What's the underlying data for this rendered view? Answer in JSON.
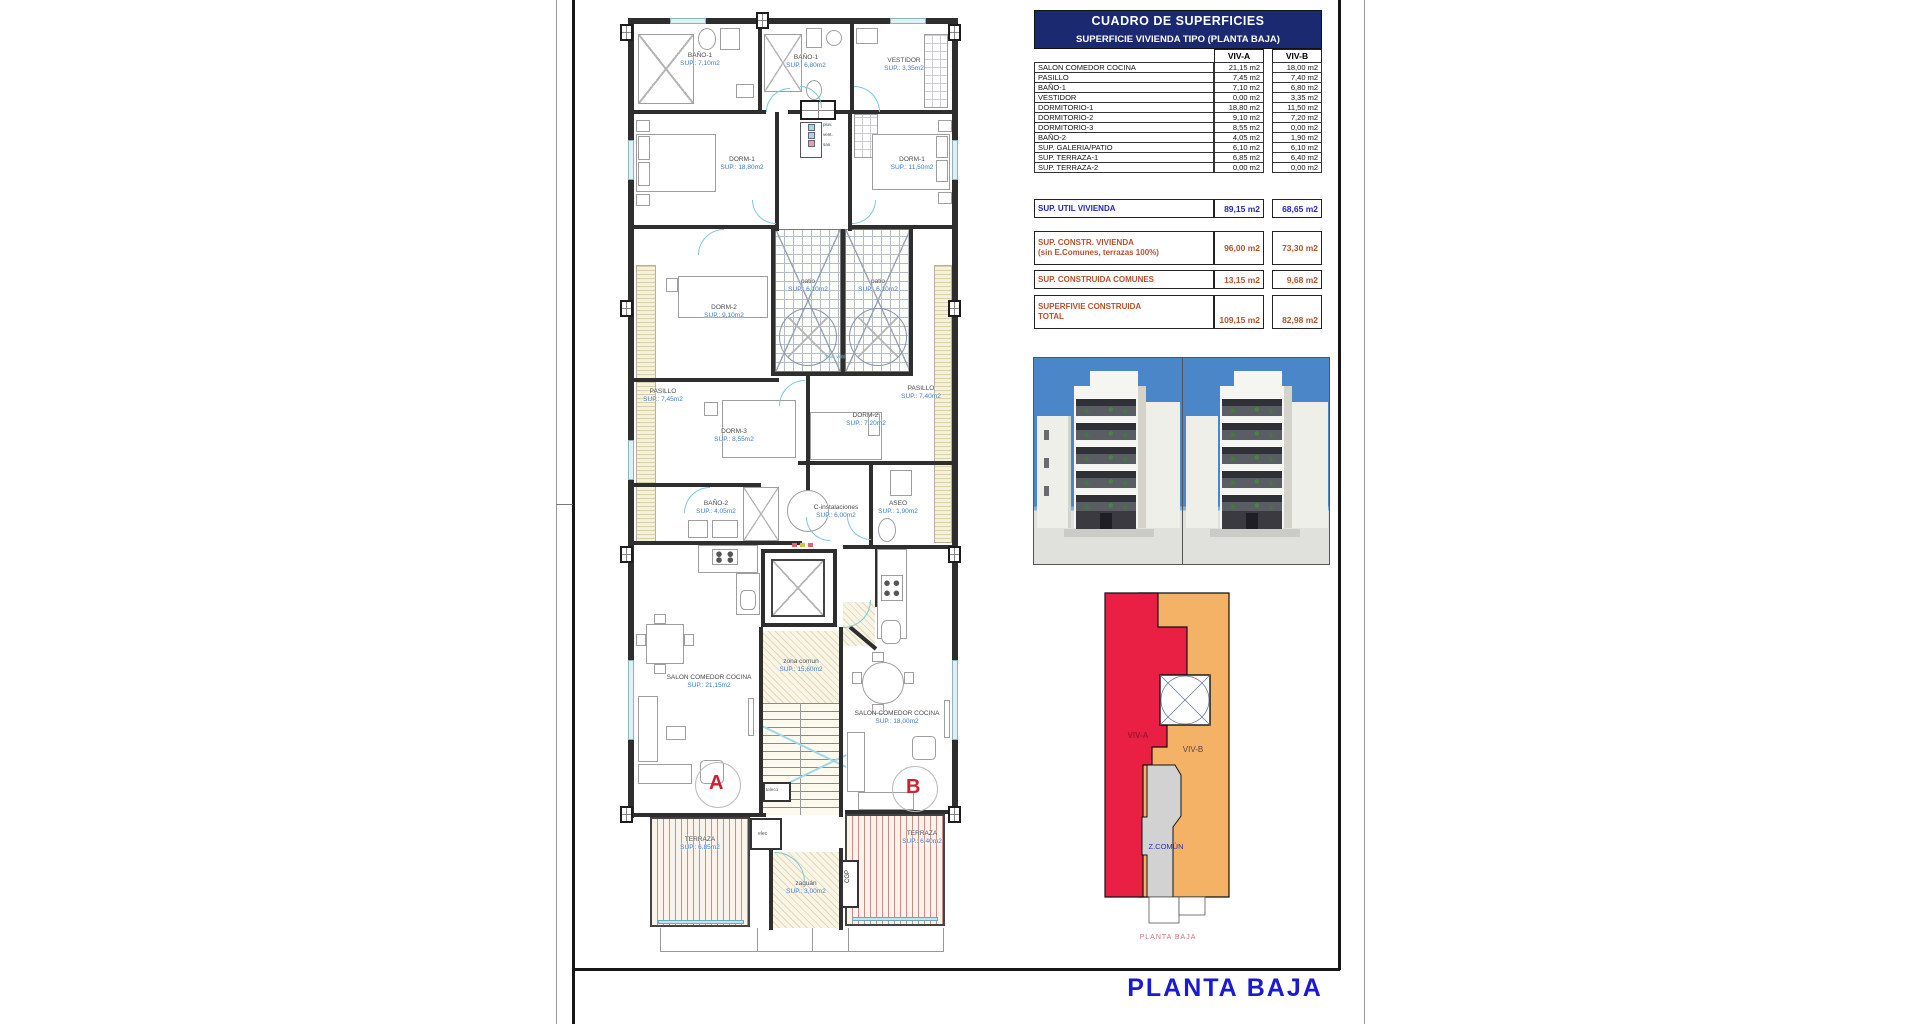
{
  "sheet": {
    "title": "PLANTA BAJA",
    "key_caption": "PLANTA BAJA"
  },
  "table": {
    "title": "CUADRO DE SUPERFICIES",
    "subtitle": "SUPERFICIE VIVIENDA TIPO  (PLANTA BAJA)",
    "col_a": "VIV-A",
    "col_b": "VIV-B",
    "rows": [
      {
        "label": "SALON COMEDOR COCINA",
        "a": "21,15 m2",
        "b": "18,00 m2"
      },
      {
        "label": "PASILLO",
        "a": "7,45 m2",
        "b": "7,40 m2"
      },
      {
        "label": "BAÑO-1",
        "a": "7,10 m2",
        "b": "6,80 m2"
      },
      {
        "label": "VESTIDOR",
        "a": "0,00 m2",
        "b": "3,35 m2"
      },
      {
        "label": "DORMITORIO-1",
        "a": "18,80 m2",
        "b": "11,50 m2"
      },
      {
        "label": "DORMITORIO-2",
        "a": "9,10 m2",
        "b": "7,20 m2"
      },
      {
        "label": "DORMITORIO-3",
        "a": "8,55 m2",
        "b": "0,00 m2"
      },
      {
        "label": "BAÑO-2",
        "a": "4,05 m2",
        "b": "1,90 m2"
      },
      {
        "label": "SUP. GALERIA/PATIO",
        "a": "6,10 m2",
        "b": "6,10 m2"
      },
      {
        "label": "SUP. TERRAZA-1",
        "a": "6,85 m2",
        "b": "6,40 m2"
      },
      {
        "label": "SUP. TERRAZA-2",
        "a": "0,00 m2",
        "b": "0,00 m2"
      }
    ],
    "summary": [
      {
        "label": "SUP. UTIL VIVIENDA",
        "label2": "",
        "a": "89,15 m2",
        "b": "68,65 m2"
      },
      {
        "label": "SUP. CONSTR. VIVIENDA",
        "label2": "(sin E.Comunes, terrazas 100%)",
        "a": "96,00 m2",
        "b": "73,30 m2"
      },
      {
        "label": "SUP. CONSTRUIDA COMUNES",
        "label2": "",
        "a": "13,15 m2",
        "b": "9,68 m2"
      },
      {
        "label": "SUPERFIVIE CONSTRUIDA",
        "label2": "TOTAL",
        "a": "109,15 m2",
        "b": "82,98 m2"
      }
    ]
  },
  "plan": {
    "unit_a": "A",
    "unit_b": "B",
    "rooms": [
      {
        "label": "BAÑO-1",
        "sup": "SUP.: 7,10m2"
      },
      {
        "label": "BAÑO-1",
        "sup": "SUP.: 6,80m2"
      },
      {
        "label": "VESTIDOR",
        "sup": "SUP.: 3,35m2"
      },
      {
        "label": "DORM-1",
        "sup": "SUP.: 18,80m2"
      },
      {
        "label": "DORM-1",
        "sup": "SUP.: 11,50m2"
      },
      {
        "label": "patio",
        "sup": "SUP.: 6,10m2"
      },
      {
        "label": "patio",
        "sup": "SUP.: 6,10m2"
      },
      {
        "label": "DORM-2",
        "sup": "SUP.: 9,10m2"
      },
      {
        "label": "PASILLO",
        "sup": "SUP.: 7,45m2"
      },
      {
        "label": "PASILLO",
        "sup": "SUP.: 7,40m2"
      },
      {
        "label": "DORM-3",
        "sup": "SUP.: 8,55m2"
      },
      {
        "label": "DORM-2'",
        "sup": "SUP.: 7,20m2"
      },
      {
        "label": "BAÑO-2",
        "sup": "SUP.: 4,05m2"
      },
      {
        "label": "C-instalaciones",
        "sup": "SUP.: 6,00m2"
      },
      {
        "label": "ASEO",
        "sup": "SUP.: 1,90m2"
      },
      {
        "label": "zona comun",
        "sup": "SUP.: 15,60m2"
      },
      {
        "label": "SALON COMEDOR COCINA",
        "sup": "SUP.: 21,15m2"
      },
      {
        "label": "SALON COMEDOR COCINA",
        "sup": "SUP.: 18,00m2"
      },
      {
        "label": "TERRAZA",
        "sup": "SUP.: 6,85m2"
      },
      {
        "label": "TERRAZA",
        "sup": "SUP.: 6,40m2"
      },
      {
        "label": "zaguán",
        "sup": "SUP.: 3,00m2"
      }
    ],
    "annotations": {
      "elec": "elec",
      "teleco": "teleco",
      "cgp": "CGP",
      "legend1": "pluv.",
      "legend2": "vent.",
      "legend3": "san.",
      "drains": "pluv. vent."
    }
  },
  "key_diagram": {
    "viv_a": "VIV-A",
    "viv_b": "VIV-B",
    "z_comun": "Z.COMÚN",
    "colors": {
      "viv_a": "#ea1f44",
      "viv_b": "#f4b266",
      "comun": "#d2d2d2"
    }
  },
  "colors": {
    "table_header_navy": "#1b2a70",
    "value_blue": "#1f27c0",
    "value_red": "#b5502e",
    "plan_sup_blue": "#3a7cc4",
    "title_blue": "#1a1ad2",
    "caption_pink": "#d4707a",
    "unit_letter_red": "#cf2030"
  }
}
